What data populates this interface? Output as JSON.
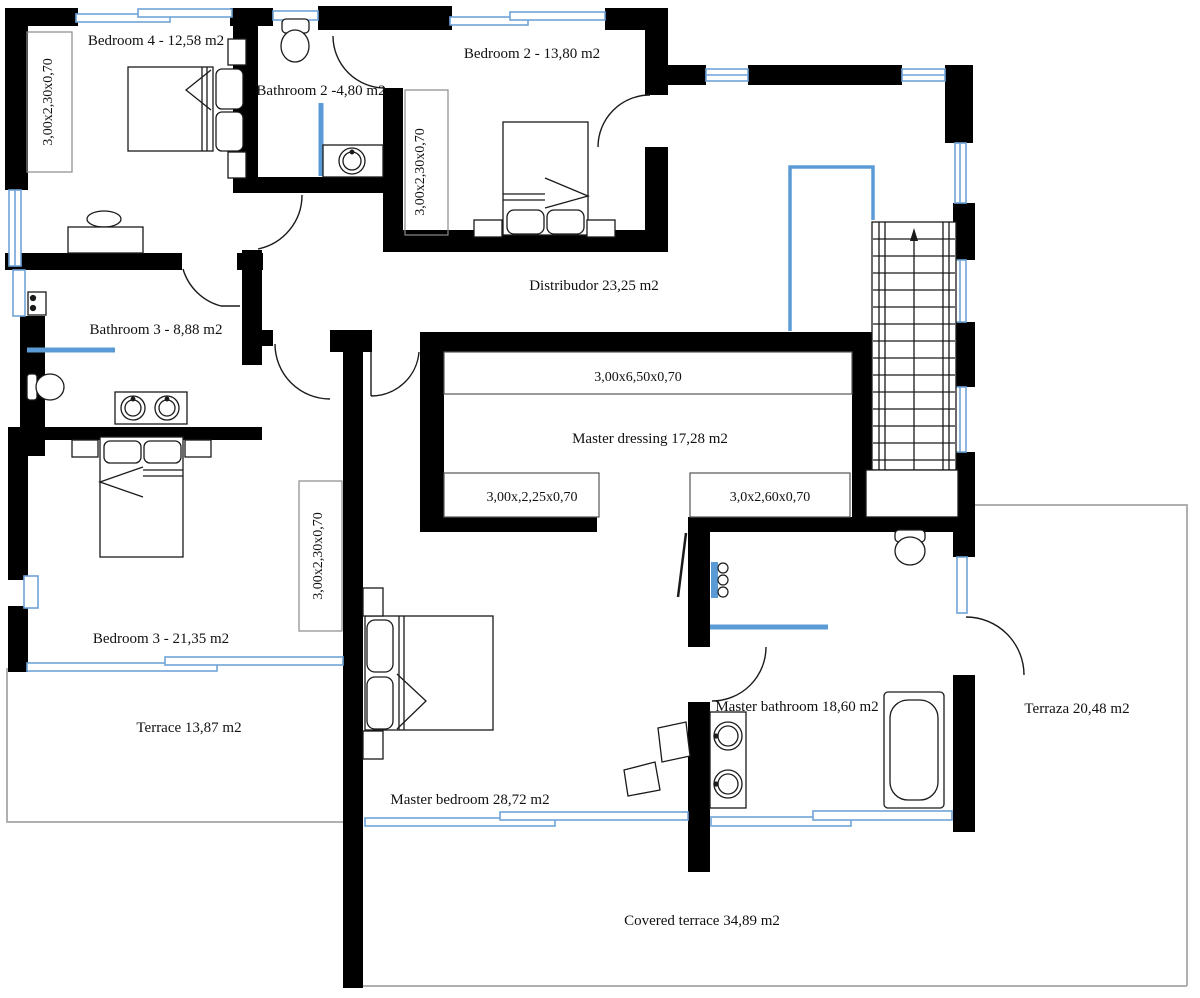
{
  "labels": {
    "bedroom4": "Bedroom 4 - 12,58 m2",
    "bathroom2": "Bathroom 2 -4,80 m2",
    "bedroom2": "Bedroom 2 - 13,80 m2",
    "distributor": "Distribudor 23,25 m2",
    "bathroom3": "Bathroom 3 - 8,88 m2",
    "master_dressing": "Master dressing 17,28 m2",
    "bedroom3": "Bedroom 3 - 21,35 m2",
    "terrace": "Terrace 13,87 m2",
    "master_bedroom": "Master bedroom 28,72 m2",
    "master_bathroom": "Master bathroom 18,60 m2",
    "terraza": "Terraza 20,48 m2",
    "covered_terrace": "Covered terrace 34,89 m2"
  },
  "dimensions": {
    "closet_standard": "3,00x2,30x0,70",
    "dressing_top": "3,00x6,50x0,70",
    "dressing_left": "3,00x,2,25x0,70",
    "dressing_right": "3,0x2,60x0,70"
  },
  "colors": {
    "wall": "#000000",
    "window_blue": "#6fa3d9",
    "fixture_blue": "#5b9bd5",
    "terrace_line": "#b0b0b0",
    "text": "#111111"
  }
}
